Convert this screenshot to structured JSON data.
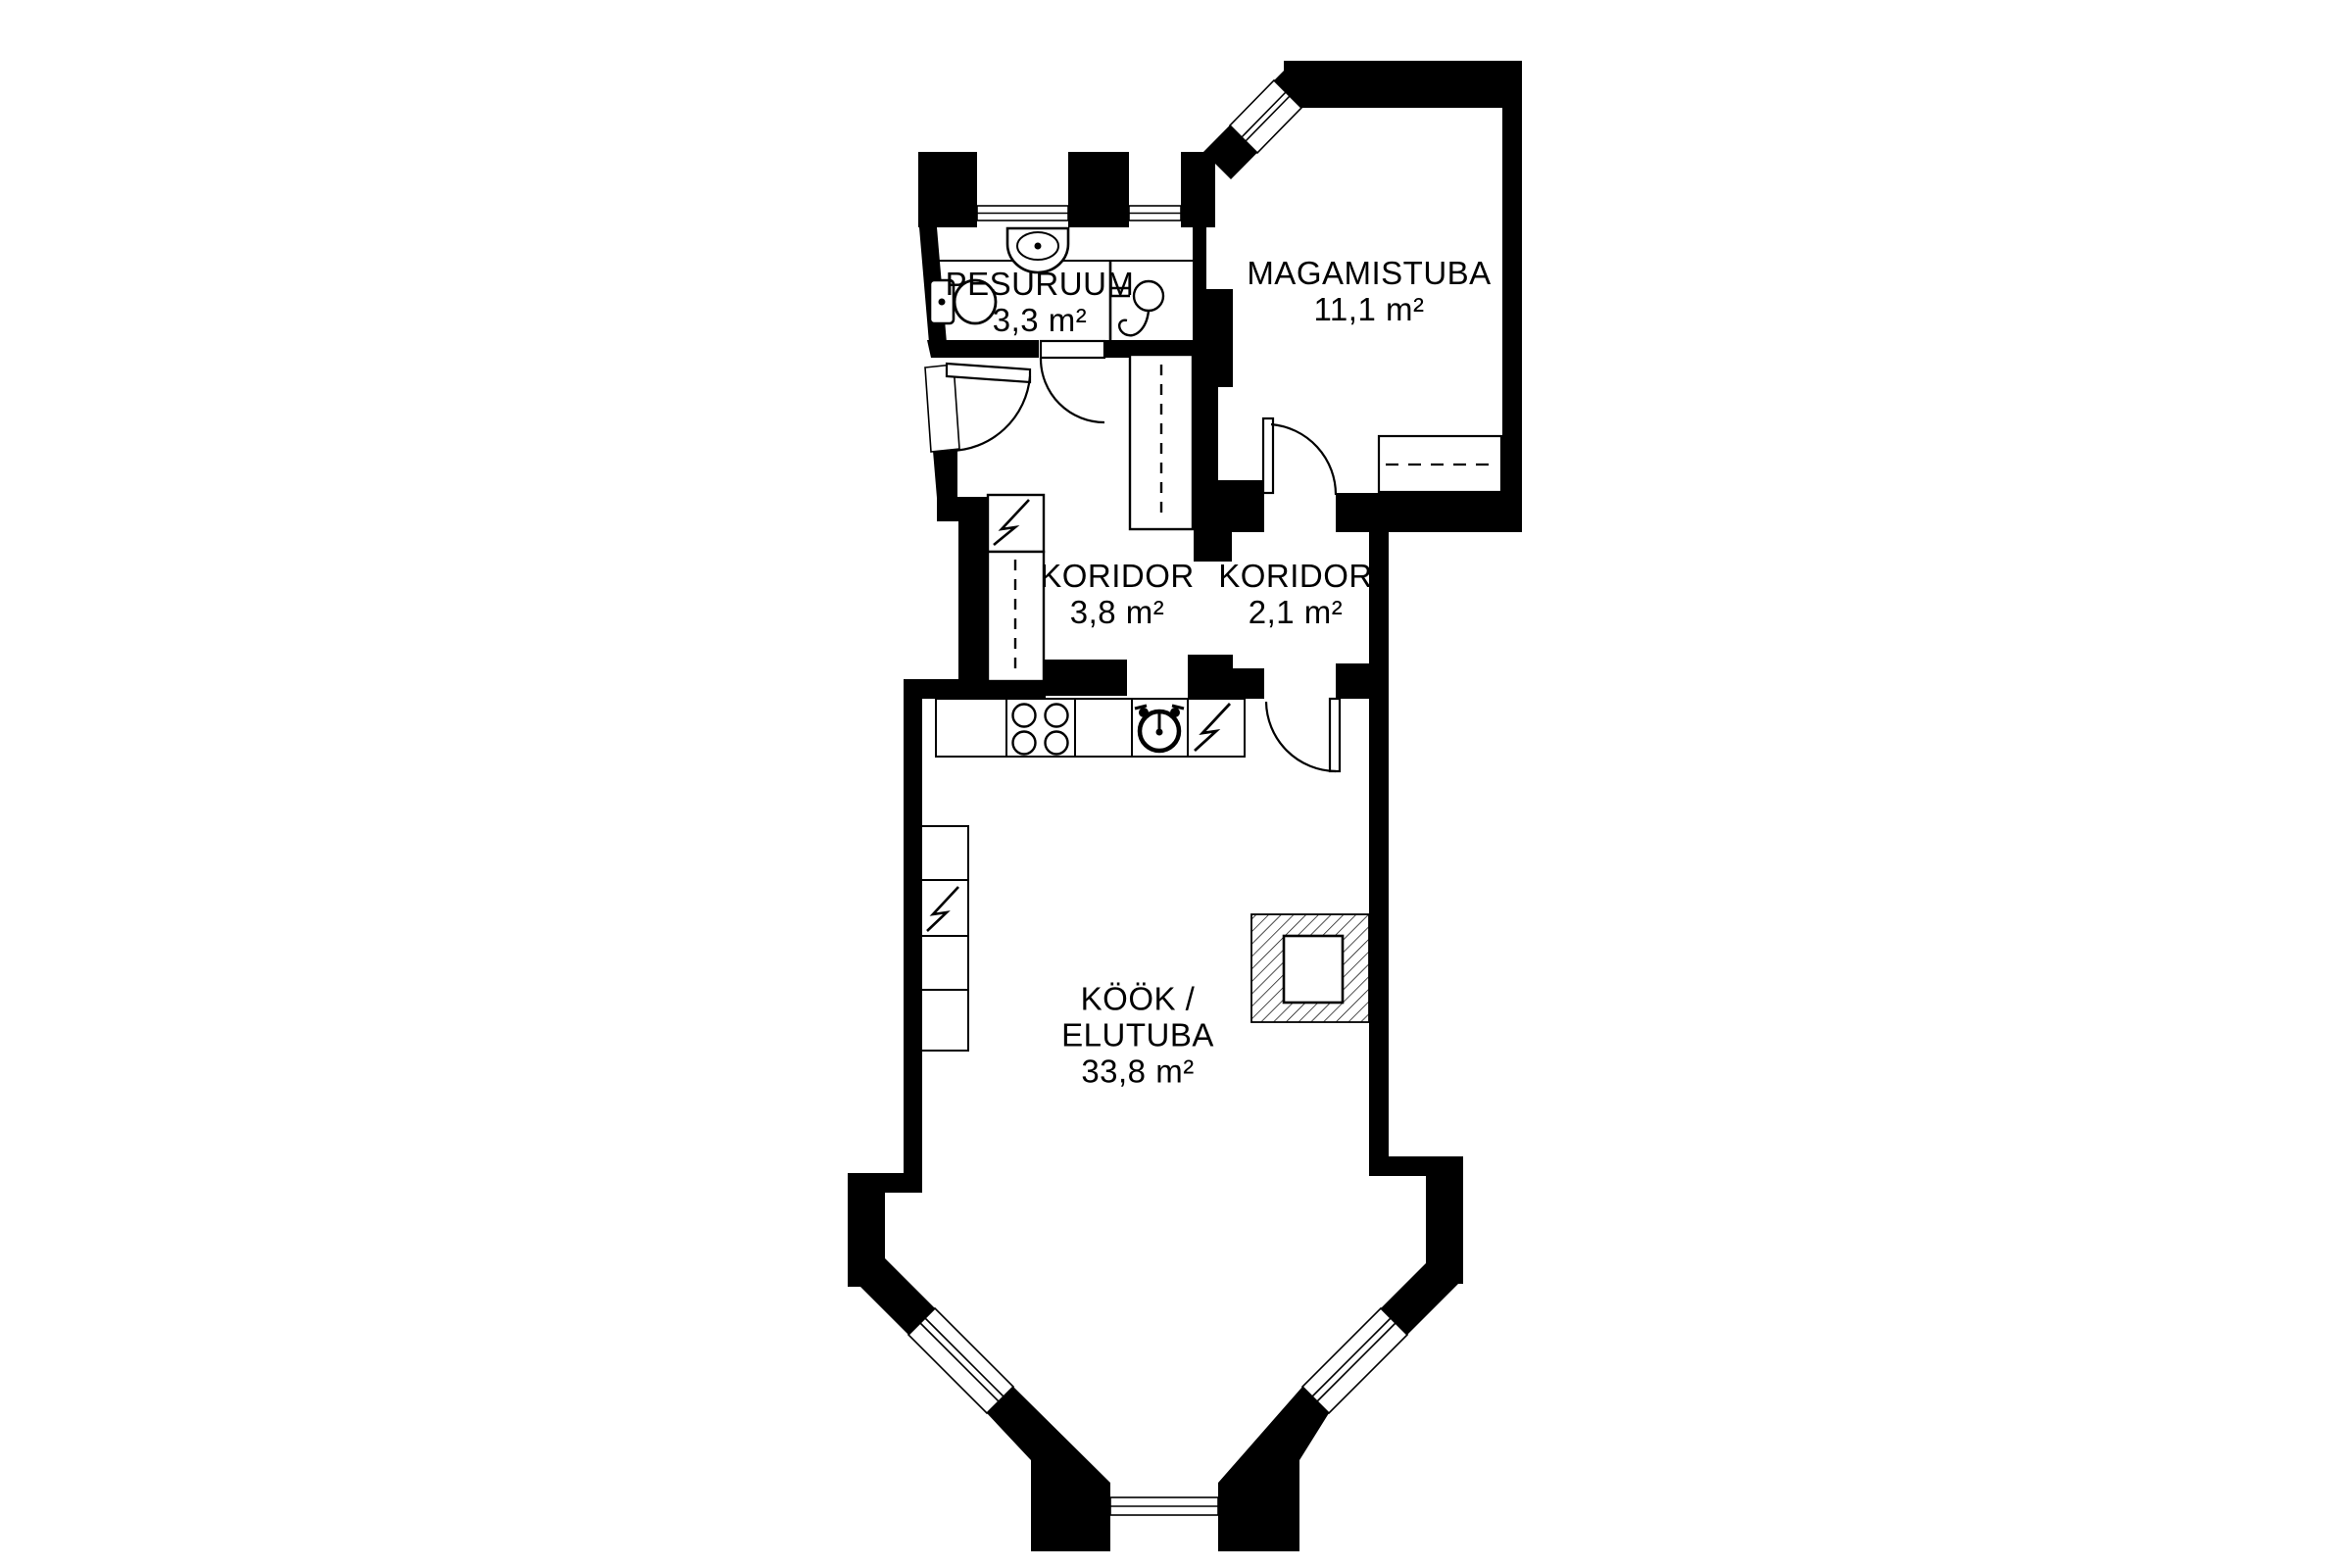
{
  "plan": {
    "background_color": "#ffffff",
    "wall_color": "#000000",
    "rooms": [
      {
        "id": "pesuruum",
        "name": "PESURUUM",
        "area": "3,3 m²"
      },
      {
        "id": "magamistuba",
        "name": "MAGAMISTUBA",
        "area": "11,1 m²"
      },
      {
        "id": "koridor-1",
        "name": "KORIDOR",
        "area": "3,8 m²"
      },
      {
        "id": "koridor-2",
        "name": "KORIDOR",
        "area": "2,1 m²"
      },
      {
        "id": "kook-elutuba",
        "name": "KÖÖK /",
        "name_line2": "ELUTUBA",
        "area": "33,8 m²"
      }
    ],
    "fixtures": {
      "bathroom": [
        "sink-icon",
        "toilet-icon",
        "shower-icon"
      ],
      "corridor": [
        "electrical-panel-icon",
        "wardrobe-icon"
      ],
      "kitchen": [
        "stove-burners-icon",
        "washing-machine-icon",
        "lightning-icon",
        "cabinet-column-icon",
        "fireplace-icon"
      ],
      "bedroom": [
        "dresser-icon"
      ],
      "openings": [
        "entry-door-icon",
        "bathroom-door-icon",
        "bedroom-door-icon",
        "kitchen-door-icon",
        "window-icon"
      ]
    }
  }
}
